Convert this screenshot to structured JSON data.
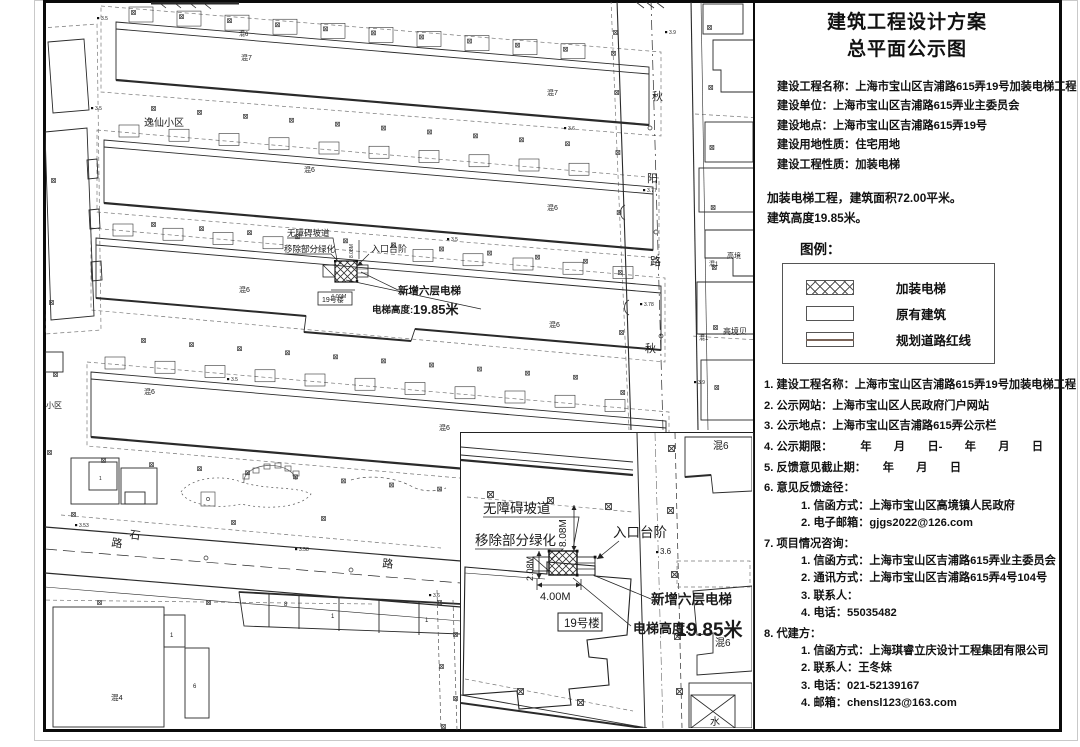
{
  "panel": {
    "title1": "建筑工程设计方案",
    "title2": "总平面公示图",
    "info_lines": [
      "建设工程名称：上海市宝山区吉浦路615弄19号加装电梯工程",
      "建设单位：上海市宝山区吉浦路615弄业主委员会",
      "建设地点：上海市宝山区吉浦路615弄19号",
      "建设用地性质：住宅用地",
      "建设工程性质：加装电梯"
    ],
    "summary_lines": [
      "加装电梯工程，建筑面积72.00平米。",
      "建筑高度19.85米。"
    ],
    "legend_title": "图例：",
    "legend_items": [
      {
        "label": "加装电梯",
        "swatch": "crosshatch"
      },
      {
        "label": "原有建筑",
        "swatch": "plain"
      },
      {
        "label": "规划道路红线",
        "swatch": "redline"
      }
    ],
    "notices": [
      {
        "text": "1. 建设工程名称：上海市宝山区吉浦路615弄19号加装电梯工程"
      },
      {
        "text": "2. 公示网站：上海市宝山区人民政府门户网站"
      },
      {
        "text": "3. 公示地点：上海市宝山区吉浦路615弄公示栏"
      },
      {
        "text": "4. 公示期限：　　　年　　月　　日-　　年　　月　　日"
      },
      {
        "text": "5. 反馈意见截止期：　　年　　月　　日"
      },
      {
        "text": "6. 意见反馈途径：",
        "children": [
          "1. 信函方式：上海市宝山区高境镇人民政府",
          "2. 电子邮箱：gjgs2022@126.com"
        ]
      },
      {
        "text": "7. 项目情况咨询：",
        "children": [
          "1. 信函方式：上海市宝山区吉浦路615弄业主委员会",
          "2. 通讯方式：上海市宝山区吉浦路615弄4号104号",
          "3. 联系人：",
          "4. 电话：55035482"
        ]
      },
      {
        "text": "8. 代建方：",
        "children": [
          "1. 信函方式：上海琪睿立庆设计工程集团有限公司",
          "2. 联系人：王冬妹",
          "3. 电话：021-52139167",
          "4. 邮箱：chensl123@163.com"
        ]
      }
    ]
  },
  "plan": {
    "building_no_label": "19号楼",
    "labels": [
      {
        "t": "逸仙小区",
        "x": 143,
        "y": 126,
        "s": 10
      },
      {
        "t": "混6",
        "x": 238,
        "y": 36,
        "s": 6
      },
      {
        "t": "混7",
        "x": 240,
        "y": 60,
        "s": 7
      },
      {
        "t": "混7",
        "x": 546,
        "y": 95,
        "s": 7
      },
      {
        "t": "混6",
        "x": 303,
        "y": 172,
        "s": 7
      },
      {
        "t": "混6",
        "x": 546,
        "y": 210,
        "s": 7
      },
      {
        "t": "混6",
        "x": 238,
        "y": 292,
        "s": 7
      },
      {
        "t": "混6",
        "x": 548,
        "y": 327,
        "s": 7
      },
      {
        "t": "混6",
        "x": 143,
        "y": 394,
        "s": 7
      },
      {
        "t": "混6",
        "x": 438,
        "y": 430,
        "s": 7
      },
      {
        "t": "混4",
        "x": 110,
        "y": 700,
        "s": 7.5
      },
      {
        "t": "高境",
        "x": 726,
        "y": 258,
        "s": 7
      },
      {
        "t": "混1",
        "x": 708,
        "y": 266,
        "s": 6
      },
      {
        "t": "高境贝",
        "x": 722,
        "y": 334,
        "s": 8
      },
      {
        "t": "混1",
        "x": 698,
        "y": 340,
        "s": 6
      },
      {
        "t": "小区",
        "x": 45,
        "y": 408,
        "s": 8
      },
      {
        "t": "秋",
        "x": 651,
        "y": 100,
        "s": 11
      },
      {
        "t": "阳",
        "x": 646,
        "y": 182,
        "s": 11
      },
      {
        "t": "路",
        "x": 649,
        "y": 265,
        "s": 11
      },
      {
        "t": "秋",
        "x": 644,
        "y": 352,
        "s": 11
      },
      {
        "t": "石",
        "x": 128,
        "y": 538,
        "s": 11,
        "r": 8
      },
      {
        "t": "路",
        "x": 110,
        "y": 546,
        "s": 11,
        "r": 8
      },
      {
        "t": "路",
        "x": 381,
        "y": 567,
        "s": 11,
        "r": 5
      },
      {
        "t": "8",
        "x": 283,
        "y": 606,
        "s": 6
      },
      {
        "t": "1",
        "x": 330,
        "y": 618,
        "s": 6
      },
      {
        "t": "1",
        "x": 424,
        "y": 622,
        "s": 6
      },
      {
        "t": "1",
        "x": 169,
        "y": 637,
        "s": 6
      },
      {
        "t": "6",
        "x": 192,
        "y": 688,
        "s": 6
      },
      {
        "t": "1",
        "x": 98,
        "y": 480,
        "s": 5
      },
      {
        "t": "3.5",
        "x": 100,
        "y": 20,
        "s": 5,
        "dot": 1
      },
      {
        "t": "3.5",
        "x": 94,
        "y": 110,
        "s": 5,
        "dot": 1
      },
      {
        "t": "3.6",
        "x": 567,
        "y": 130,
        "s": 5,
        "dot": 1
      },
      {
        "t": "3.9",
        "x": 668,
        "y": 34,
        "s": 5,
        "dot": 1
      },
      {
        "t": "3.77",
        "x": 646,
        "y": 192,
        "s": 5,
        "dot": 1
      },
      {
        "t": "3.78",
        "x": 643,
        "y": 306,
        "s": 5,
        "dot": 1
      },
      {
        "t": "3.9",
        "x": 697,
        "y": 384,
        "s": 5,
        "dot": 1
      },
      {
        "t": "3.53",
        "x": 78,
        "y": 527,
        "s": 5,
        "dot": 1
      },
      {
        "t": "3.58",
        "x": 298,
        "y": 551,
        "s": 5,
        "dot": 1
      },
      {
        "t": "3.6",
        "x": 432,
        "y": 597,
        "s": 5,
        "dot": 1
      },
      {
        "t": "3.5",
        "x": 230,
        "y": 381,
        "s": 5,
        "dot": 1
      },
      {
        "t": "3.5",
        "x": 450,
        "y": 241,
        "s": 5,
        "dot": 1
      },
      {
        "t": "无障碍坡道",
        "x": 286,
        "y": 236,
        "s": 8.5
      },
      {
        "t": "移除部分绿化",
        "x": 283,
        "y": 252,
        "s": 8.5
      },
      {
        "t": "入口台阶",
        "x": 370,
        "y": 252,
        "s": 9
      },
      {
        "t": "新增六层电梯",
        "x": 397,
        "y": 294,
        "s": 10.5,
        "b": 1
      },
      {
        "t": "电梯高度:",
        "x": 371,
        "y": 313,
        "s": 9.5,
        "b": 1
      },
      {
        "t": "19.85米",
        "x": 412,
        "y": 314,
        "s": 13,
        "b": 1
      },
      {
        "t": "4.00M",
        "x": 330,
        "y": 298,
        "s": 5.5
      },
      {
        "t": "8.08M",
        "x": 352,
        "y": 258,
        "s": 5,
        "r": -90
      }
    ],
    "inset_labels": [
      {
        "t": "无障碍坡道",
        "x": 22,
        "y": 80,
        "s": 13.5
      },
      {
        "t": "移除部分绿化",
        "x": 14,
        "y": 112,
        "s": 13.5
      },
      {
        "t": "入口台阶",
        "x": 152,
        "y": 104,
        "s": 13.5
      },
      {
        "t": "新增六层电梯",
        "x": 190,
        "y": 171,
        "s": 13.5,
        "b": 1
      },
      {
        "t": "电梯高度:",
        "x": 172,
        "y": 200,
        "s": 13,
        "b": 1
      },
      {
        "t": "19.85米",
        "x": 215,
        "y": 203,
        "s": 19,
        "b": 1
      },
      {
        "t": "混6",
        "x": 252,
        "y": 16,
        "s": 10
      },
      {
        "t": "混6",
        "x": 254,
        "y": 213,
        "s": 10
      },
      {
        "t": "3.6",
        "x": 199,
        "y": 121,
        "s": 8,
        "dot": 1
      },
      {
        "t": "水",
        "x": 249,
        "y": 292,
        "s": 10
      },
      {
        "t": "8.08M",
        "x": 105,
        "y": 114,
        "s": 10,
        "r": -90
      },
      {
        "t": "2.08M",
        "x": 72,
        "y": 148,
        "s": 9,
        "r": -90
      },
      {
        "t": "4.00M",
        "x": 79,
        "y": 167,
        "s": 11
      }
    ]
  }
}
